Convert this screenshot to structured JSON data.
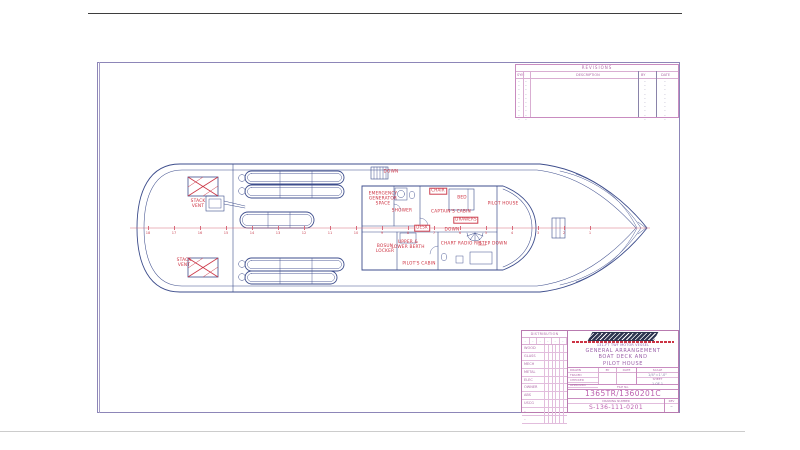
{
  "revisions": {
    "title": "REVISIONS",
    "columns": {
      "sym": "SYM",
      "no": "NO",
      "description": "DESCRIPTION",
      "by": "BY",
      "date": "DATE"
    },
    "empty_rows": 10,
    "row_dash": "–"
  },
  "plan": {
    "labels": [
      {
        "id": "down-aft-stair",
        "text": "DOWN",
        "x": 391,
        "y": 173,
        "boxed": false
      },
      {
        "id": "emergency-generator-space",
        "text": "EMERGENCY\nGENERATOR\nSPACE",
        "x": 383,
        "y": 200,
        "boxed": false
      },
      {
        "id": "shower",
        "text": "SHOWER",
        "x": 402,
        "y": 212,
        "boxed": false
      },
      {
        "id": "chair",
        "text": "CHAIR",
        "x": 438,
        "y": 191,
        "boxed": true
      },
      {
        "id": "bed",
        "text": "BED",
        "x": 462,
        "y": 199,
        "boxed": false
      },
      {
        "id": "captains-cabin",
        "text": "CAPTAIN'S CABIN",
        "x": 451,
        "y": 213,
        "boxed": false
      },
      {
        "id": "pilot-house",
        "text": "PILOT HOUSE",
        "x": 503,
        "y": 205,
        "boxed": false
      },
      {
        "id": "drawers",
        "text": "DRAWERS",
        "x": 466,
        "y": 220,
        "boxed": true
      },
      {
        "id": "desk",
        "text": "DESK",
        "x": 422,
        "y": 228,
        "boxed": true
      },
      {
        "id": "down-spiral-stair",
        "text": "DOWN",
        "x": 452,
        "y": 231,
        "boxed": false
      },
      {
        "id": "bosun-locker",
        "text": "BOSUN\nLOCKER",
        "x": 385,
        "y": 250,
        "boxed": false
      },
      {
        "id": "upper-lower-berth",
        "text": "UPPER &\nLOWER BERTH",
        "x": 408,
        "y": 246,
        "boxed": false
      },
      {
        "id": "pilots-cabin",
        "text": "PILOT'S CABIN",
        "x": 419,
        "y": 265,
        "boxed": false
      },
      {
        "id": "chart-radio-rm",
        "text": "CHART RADIO RM",
        "x": 461,
        "y": 245,
        "boxed": false
      },
      {
        "id": "step-down",
        "text": "STEP DOWN",
        "x": 493,
        "y": 245,
        "boxed": false
      },
      {
        "id": "stack-vent-aft-upper",
        "text": "STACK\nVENT",
        "x": 198,
        "y": 205,
        "boxed": false
      },
      {
        "id": "stack-vent-aft-lower",
        "text": "STACK\nVENT",
        "x": 184,
        "y": 264,
        "boxed": false
      }
    ],
    "frames": {
      "y": 228,
      "x_start": 148,
      "x_step": 26,
      "numbers": [
        "18",
        "17",
        "16",
        "15",
        "14",
        "13",
        "12",
        "11",
        "10",
        "9",
        "8",
        "7",
        "6",
        "5",
        "4",
        "3",
        "2",
        "1"
      ]
    }
  },
  "title_block": {
    "distribution": {
      "title": "DISTRIBUTION",
      "rows": [
        "WOOD",
        "GLASS",
        "MECH",
        "METAL",
        "ELEC",
        "OWNER",
        "ABS",
        "USCG",
        "–",
        "–"
      ]
    },
    "vessel_line": "131-FT TWF MOTOR VESSEL",
    "title_lines": [
      "GENERAL ARRANGEMENT",
      "BOAT DECK AND",
      "PILOT HOUSE"
    ],
    "approval_rows": [
      "DRAWN",
      "TRACED",
      "CHECKED",
      "APPROVED"
    ],
    "by_label": "BY",
    "date_label": "DATE",
    "scale_label": "SCALE",
    "scale_value": "1/4\"=1'-0\"",
    "sheet_label": "SHEET",
    "sheet_value": "1 OF 1",
    "file_label": "FILE No.",
    "file_value": "1365TR/1360201C",
    "drawing_number_label": "DRAWING NUMBER",
    "drawing_number": "S-136-111-0201",
    "rev_label": "REV",
    "rev_value": "–"
  },
  "colors": {
    "line_blue": "#3d4d8c",
    "grid_pink": "#c98cc0",
    "label_red": "#cc2f3f",
    "border_purple": "#8d86b8"
  }
}
